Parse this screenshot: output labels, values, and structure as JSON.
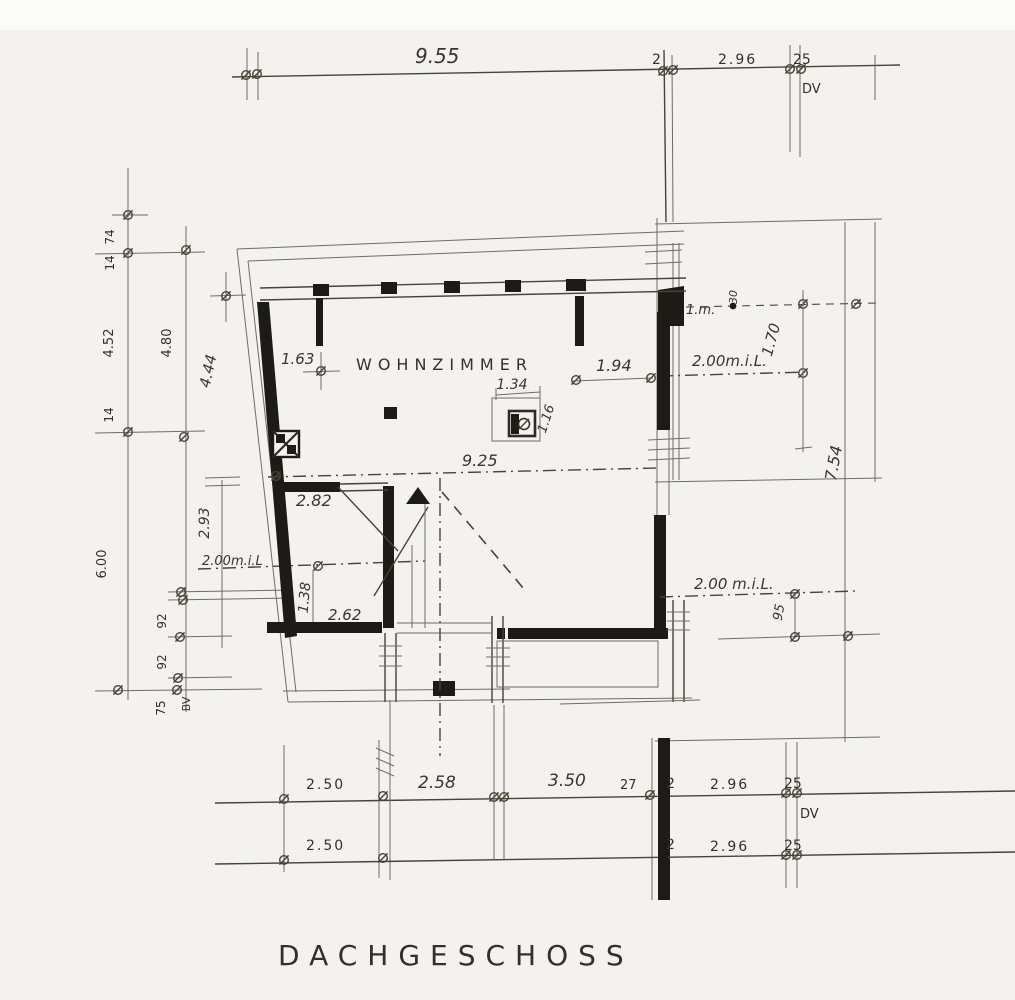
{
  "drawing": {
    "title": "DACHGESCHOSS",
    "room_label": "WOHNZIMMER",
    "dims": {
      "top": {
        "d955": "9.55",
        "d2": "2",
        "d296": "2.96",
        "d25": "25",
        "dv": "DV"
      },
      "left": {
        "d74": "74",
        "d14a": "14",
        "d452": "4.52",
        "d480": "4.80",
        "d14b": "14",
        "d444": "4.44",
        "d293": "2.93",
        "dmil": "2.00m.i.L",
        "d600": "6.00",
        "d92a": "92",
        "d92b": "92",
        "d75": "75",
        "dbv": "BV"
      },
      "plan": {
        "d163": "1.63",
        "d194": "1.94",
        "d134": "1.34",
        "d116": "1.16",
        "d925": "9.25",
        "d282": "2.82",
        "d138": "1.38",
        "d262": "2.62"
      },
      "right": {
        "d1m": "1.m.",
        "d30": "30",
        "dmil_top": "2.00m.i.L.",
        "d170": "1.70",
        "d754": "7.54",
        "dmil_bot": "2.00 m.i.L.",
        "d95": "95"
      },
      "bottom_row1": {
        "d250": "2.50",
        "d258": "2.58",
        "d350": "3.50",
        "d27": "27",
        "d2": "2",
        "d296": "2.96",
        "d25": "25",
        "dv": "DV"
      },
      "bottom_row2": {
        "d250": "2.50",
        "d2": "2",
        "d296": "2.96",
        "d25": "25"
      }
    }
  }
}
